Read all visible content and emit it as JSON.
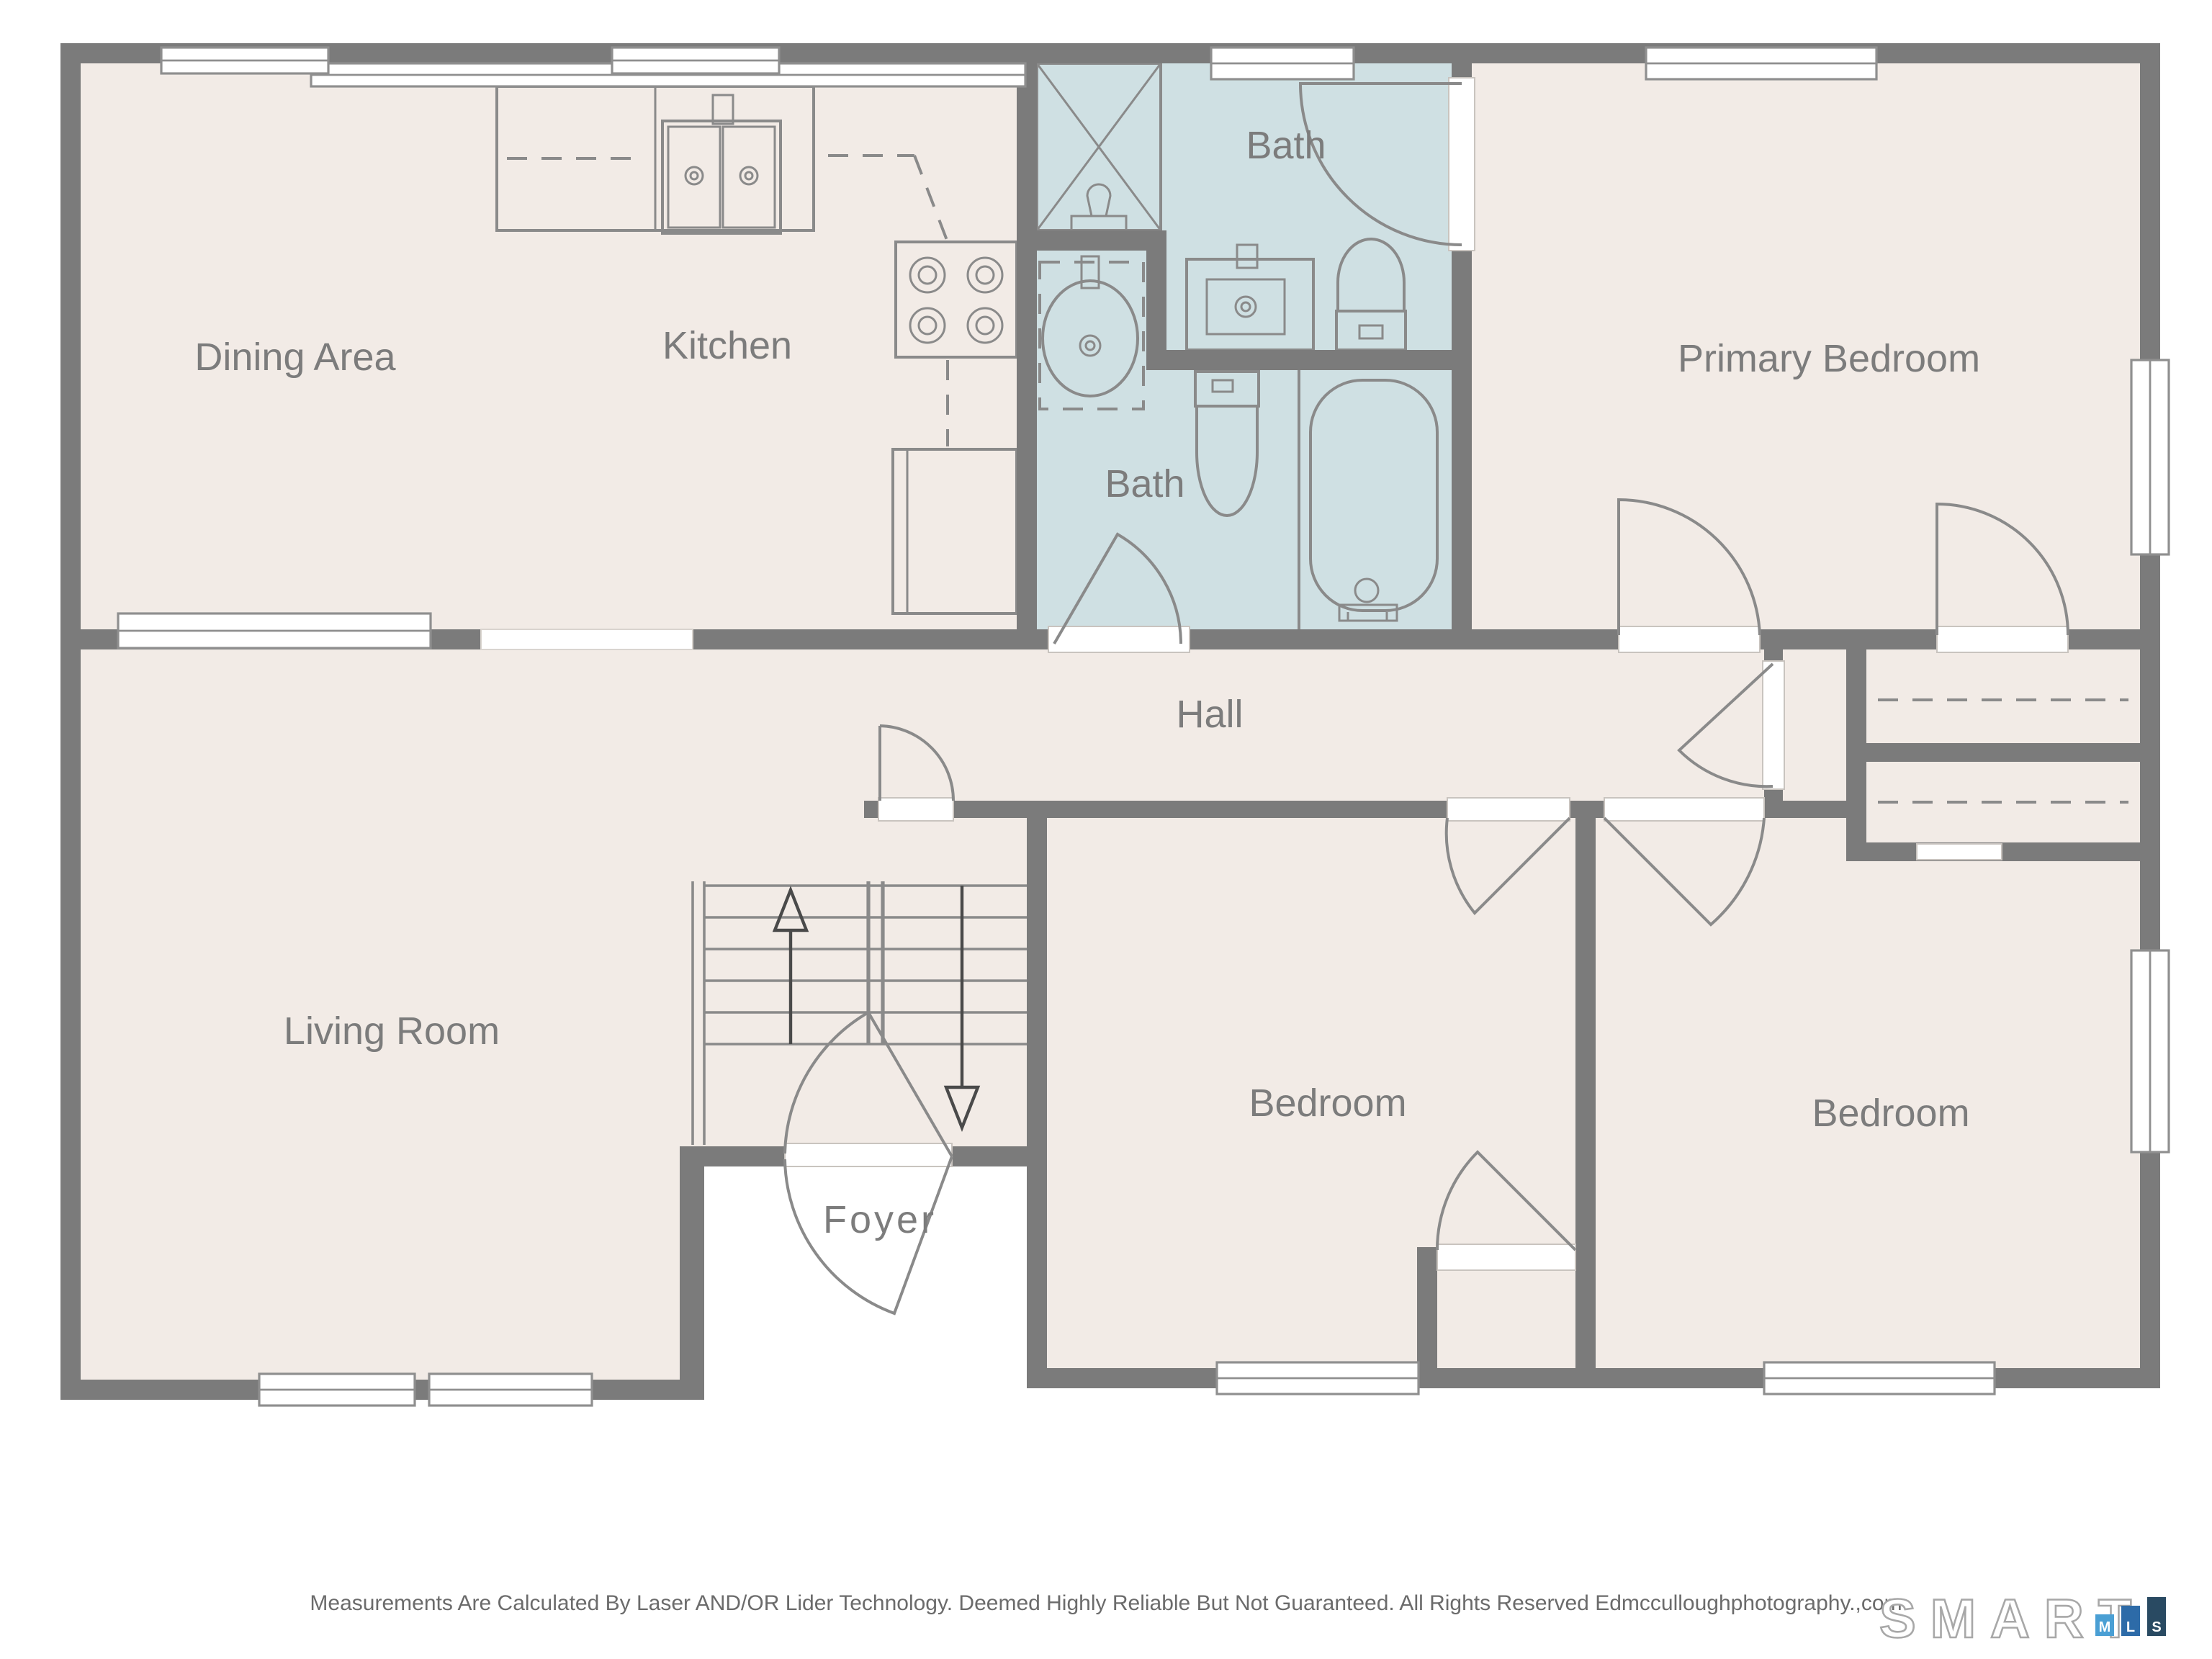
{
  "plan": {
    "rooms": {
      "dining": "Dining Area",
      "kitchen": "Kitchen",
      "bath_upper": "Bath",
      "bath_lower": "Bath",
      "primary_bedroom": "Primary Bedroom",
      "hall": "Hall",
      "living_room": "Living Room",
      "foyer": "Foyer",
      "bedroom_middle": "Bedroom",
      "bedroom_right": "Bedroom"
    },
    "fixtures": [
      "shower",
      "vanity-sink",
      "round-sink",
      "toilet",
      "bathtub",
      "kitchen-double-sink",
      "stove",
      "refrigerator",
      "stairs-up",
      "stairs-down",
      "closet-rods"
    ]
  },
  "footer": {
    "disclaimer": "Measurements Are Calculated By Laser AND/OR Lider Technology. Deemed Highly Reliable But Not Guaranteed. All Rights Reserved Edmcculloughphotography.,com"
  },
  "logo": {
    "brand": "SMART",
    "blocks": [
      {
        "letter": "M",
        "color": "#4a9fd4"
      },
      {
        "letter": "L",
        "color": "#2d6ba8"
      },
      {
        "letter": "S",
        "color": "#294a62"
      }
    ]
  },
  "colors": {
    "wall": "#7b7b7b",
    "floor": "#f2ebe6",
    "bath_floor": "#cfe0e3",
    "label": "#7c7c7c",
    "fixture_line": "#8a8a8a"
  }
}
